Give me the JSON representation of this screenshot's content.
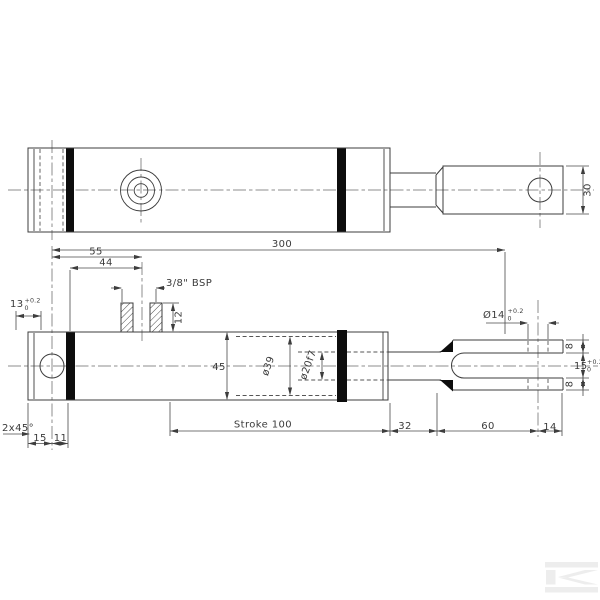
{
  "labels": {
    "eye_width": "30",
    "overall_length": "300",
    "port_pos_outer": "55",
    "port_pos_inner": "44",
    "port_thread": "3/8\" BSP",
    "port_depth": "12",
    "rear_width": {
      "value": "13",
      "tol_up": "+0.2",
      "tol_dn": "0"
    },
    "chamfer": "2x45°",
    "rear_dim_a": "15",
    "rear_dim_b": "11",
    "barrel_od": "45",
    "bore_dia": "ø39",
    "rod_dia": "ø20f7",
    "stroke": "Stroke 100",
    "rod_extension": "32",
    "fork_length": "60",
    "fork_tip": "14",
    "fork_hole": {
      "value": "Ø14",
      "tol_up": "+0.2",
      "tol_dn": "0"
    },
    "prong_top": "8",
    "prong_bottom": "8",
    "slot_width": {
      "value": "15",
      "tol_up": "+0.2",
      "tol_dn": "0"
    },
    "watermark_letter": "K"
  },
  "colors": {
    "background": "#ffffff",
    "outline": "#3c3c3c",
    "dimension": "#4a4a4a",
    "seal_band": "#0d0d0d",
    "watermark": "#ededed"
  }
}
